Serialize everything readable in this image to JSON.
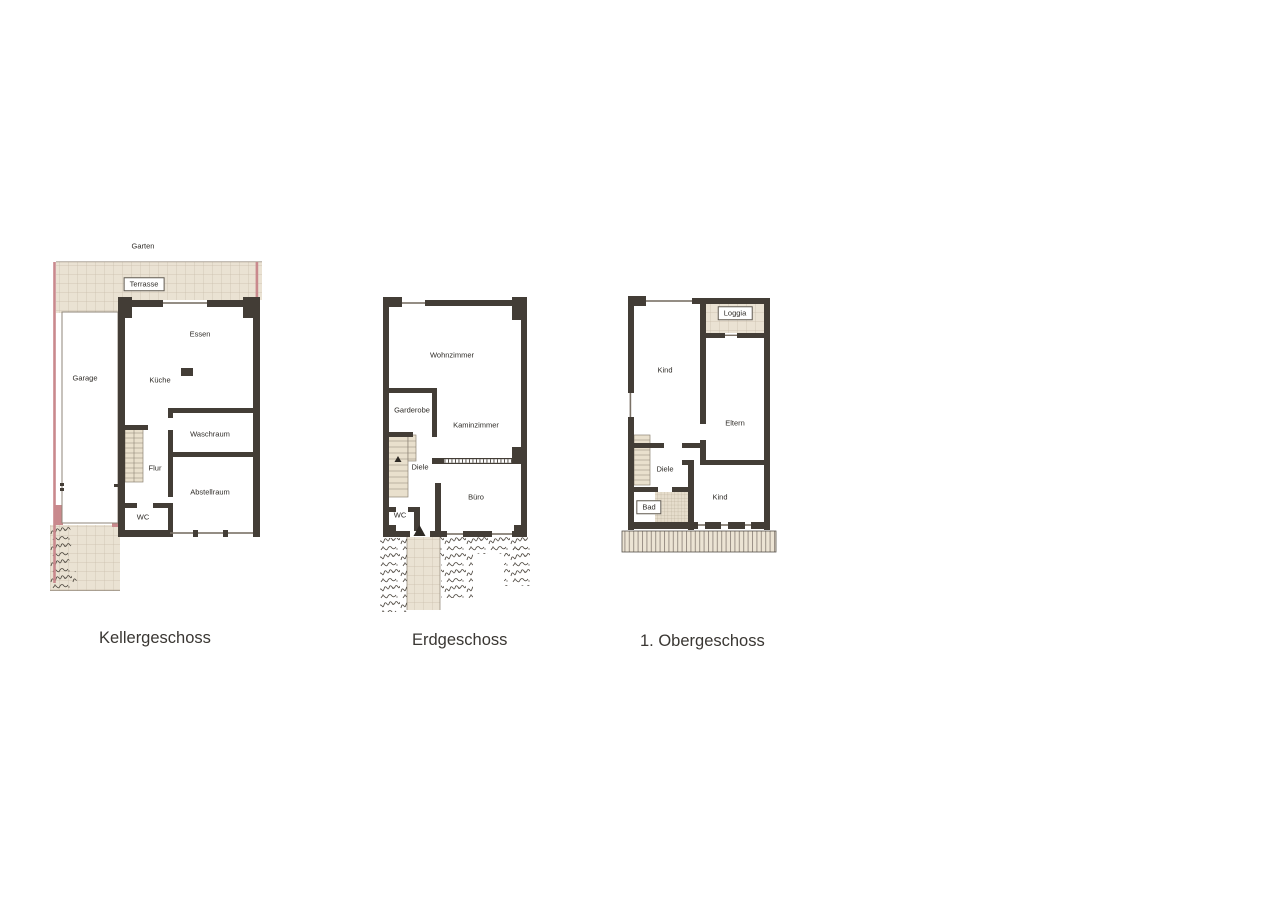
{
  "document": {
    "background": "#ffffff",
    "type_note": "three floor plans of a house"
  },
  "colors": {
    "wall": "#433d36",
    "tile_background": "#eae2d3",
    "tile_line": "#c9beab",
    "pink_boundary": "#c9898d",
    "stairs": "#e9e0cd",
    "window_line": "#7a7166",
    "text": "#2e2b27"
  },
  "plans": [
    {
      "caption": "Kellergeschoss",
      "labels": {
        "garten": "Garten",
        "terrasse": "Terrasse",
        "garage": "Garage",
        "essen": "Essen",
        "kueche": "Küche",
        "waschraum": "Waschraum",
        "flur": "Flur",
        "abstellraum": "Abstellraum",
        "wc": "WC"
      }
    },
    {
      "caption": "Erdgeschoss",
      "labels": {
        "wohnzimmer": "Wohnzimmer",
        "garderobe": "Garderobe",
        "kaminzimmer": "Kaminzimmer",
        "diele": "Diele",
        "wc": "WC",
        "buero": "Büro"
      }
    },
    {
      "caption": "1. Obergeschoss",
      "labels": {
        "kind_oben": "Kind",
        "loggia": "Loggia",
        "eltern": "Eltern",
        "diele": "Diele",
        "bad": "Bad",
        "kind_unten": "Kind"
      }
    }
  ]
}
